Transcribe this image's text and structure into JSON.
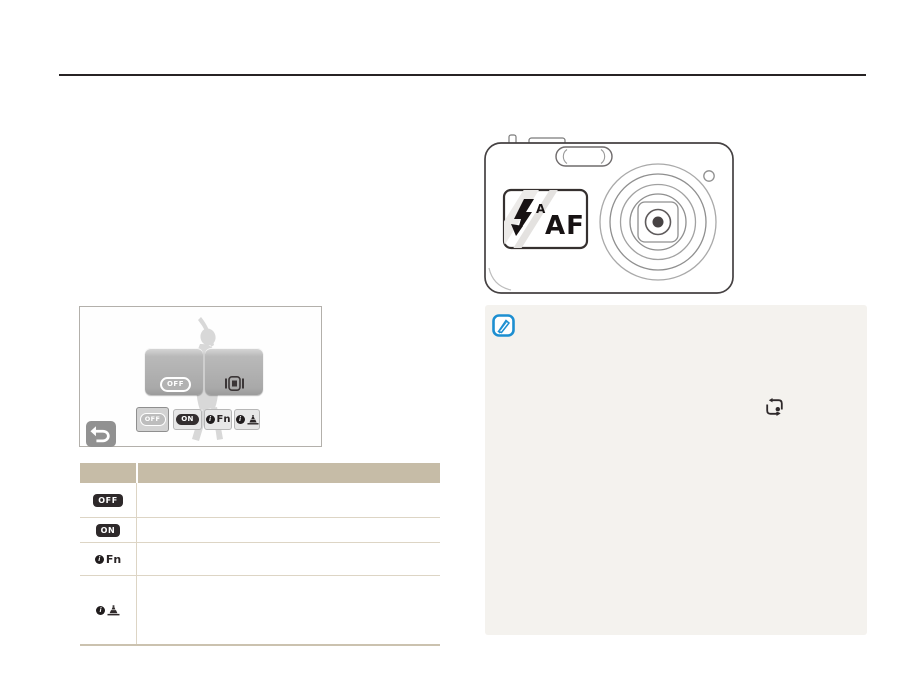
{
  "labels": {
    "off": "OFF",
    "on": "ON",
    "fn": "Fn",
    "info_mark": "i"
  },
  "camera_display": {
    "flash_mode_superscript": "A",
    "focus_label": "AF"
  },
  "screen_ui": {
    "big_buttons": [
      {
        "name": "display-off-button",
        "label": "OFF"
      },
      {
        "name": "display-on-button",
        "icon": "lcd-display-icon"
      }
    ],
    "option_buttons": [
      {
        "name": "option-off",
        "label": "OFF",
        "selected": true
      },
      {
        "name": "option-on",
        "label": "ON"
      },
      {
        "name": "option-fn",
        "label": "Fn",
        "icon": "info-icon"
      },
      {
        "name": "option-guide",
        "icon": "info-landmark-icon"
      }
    ],
    "back_button_icon": "return-arrow-icon"
  },
  "table": {
    "columns": [
      "",
      ""
    ],
    "rows": [
      {
        "icon": "off-badge",
        "label": "OFF",
        "description": ""
      },
      {
        "icon": "on-badge",
        "label": "ON",
        "description": ""
      },
      {
        "icon": "info-fn-icon",
        "label": "Fn",
        "description": ""
      },
      {
        "icon": "info-landmark-icon",
        "label": "",
        "description": ""
      }
    ]
  },
  "note": {
    "icon": "note-pencil-icon",
    "inline_icon": "smart-frame-icon",
    "text": ""
  },
  "colors": {
    "top_rule": "#272324",
    "table_header_bg": "#c6bca7",
    "table_line": "#ddd5c5",
    "table_bottom_border": "#cbc2af",
    "note_box_bg": "#f4f2ee",
    "note_icon_blue": "#1d8fd1",
    "dark_icon": "#2e292a",
    "silhouette_gray": "#d8d8d8"
  }
}
